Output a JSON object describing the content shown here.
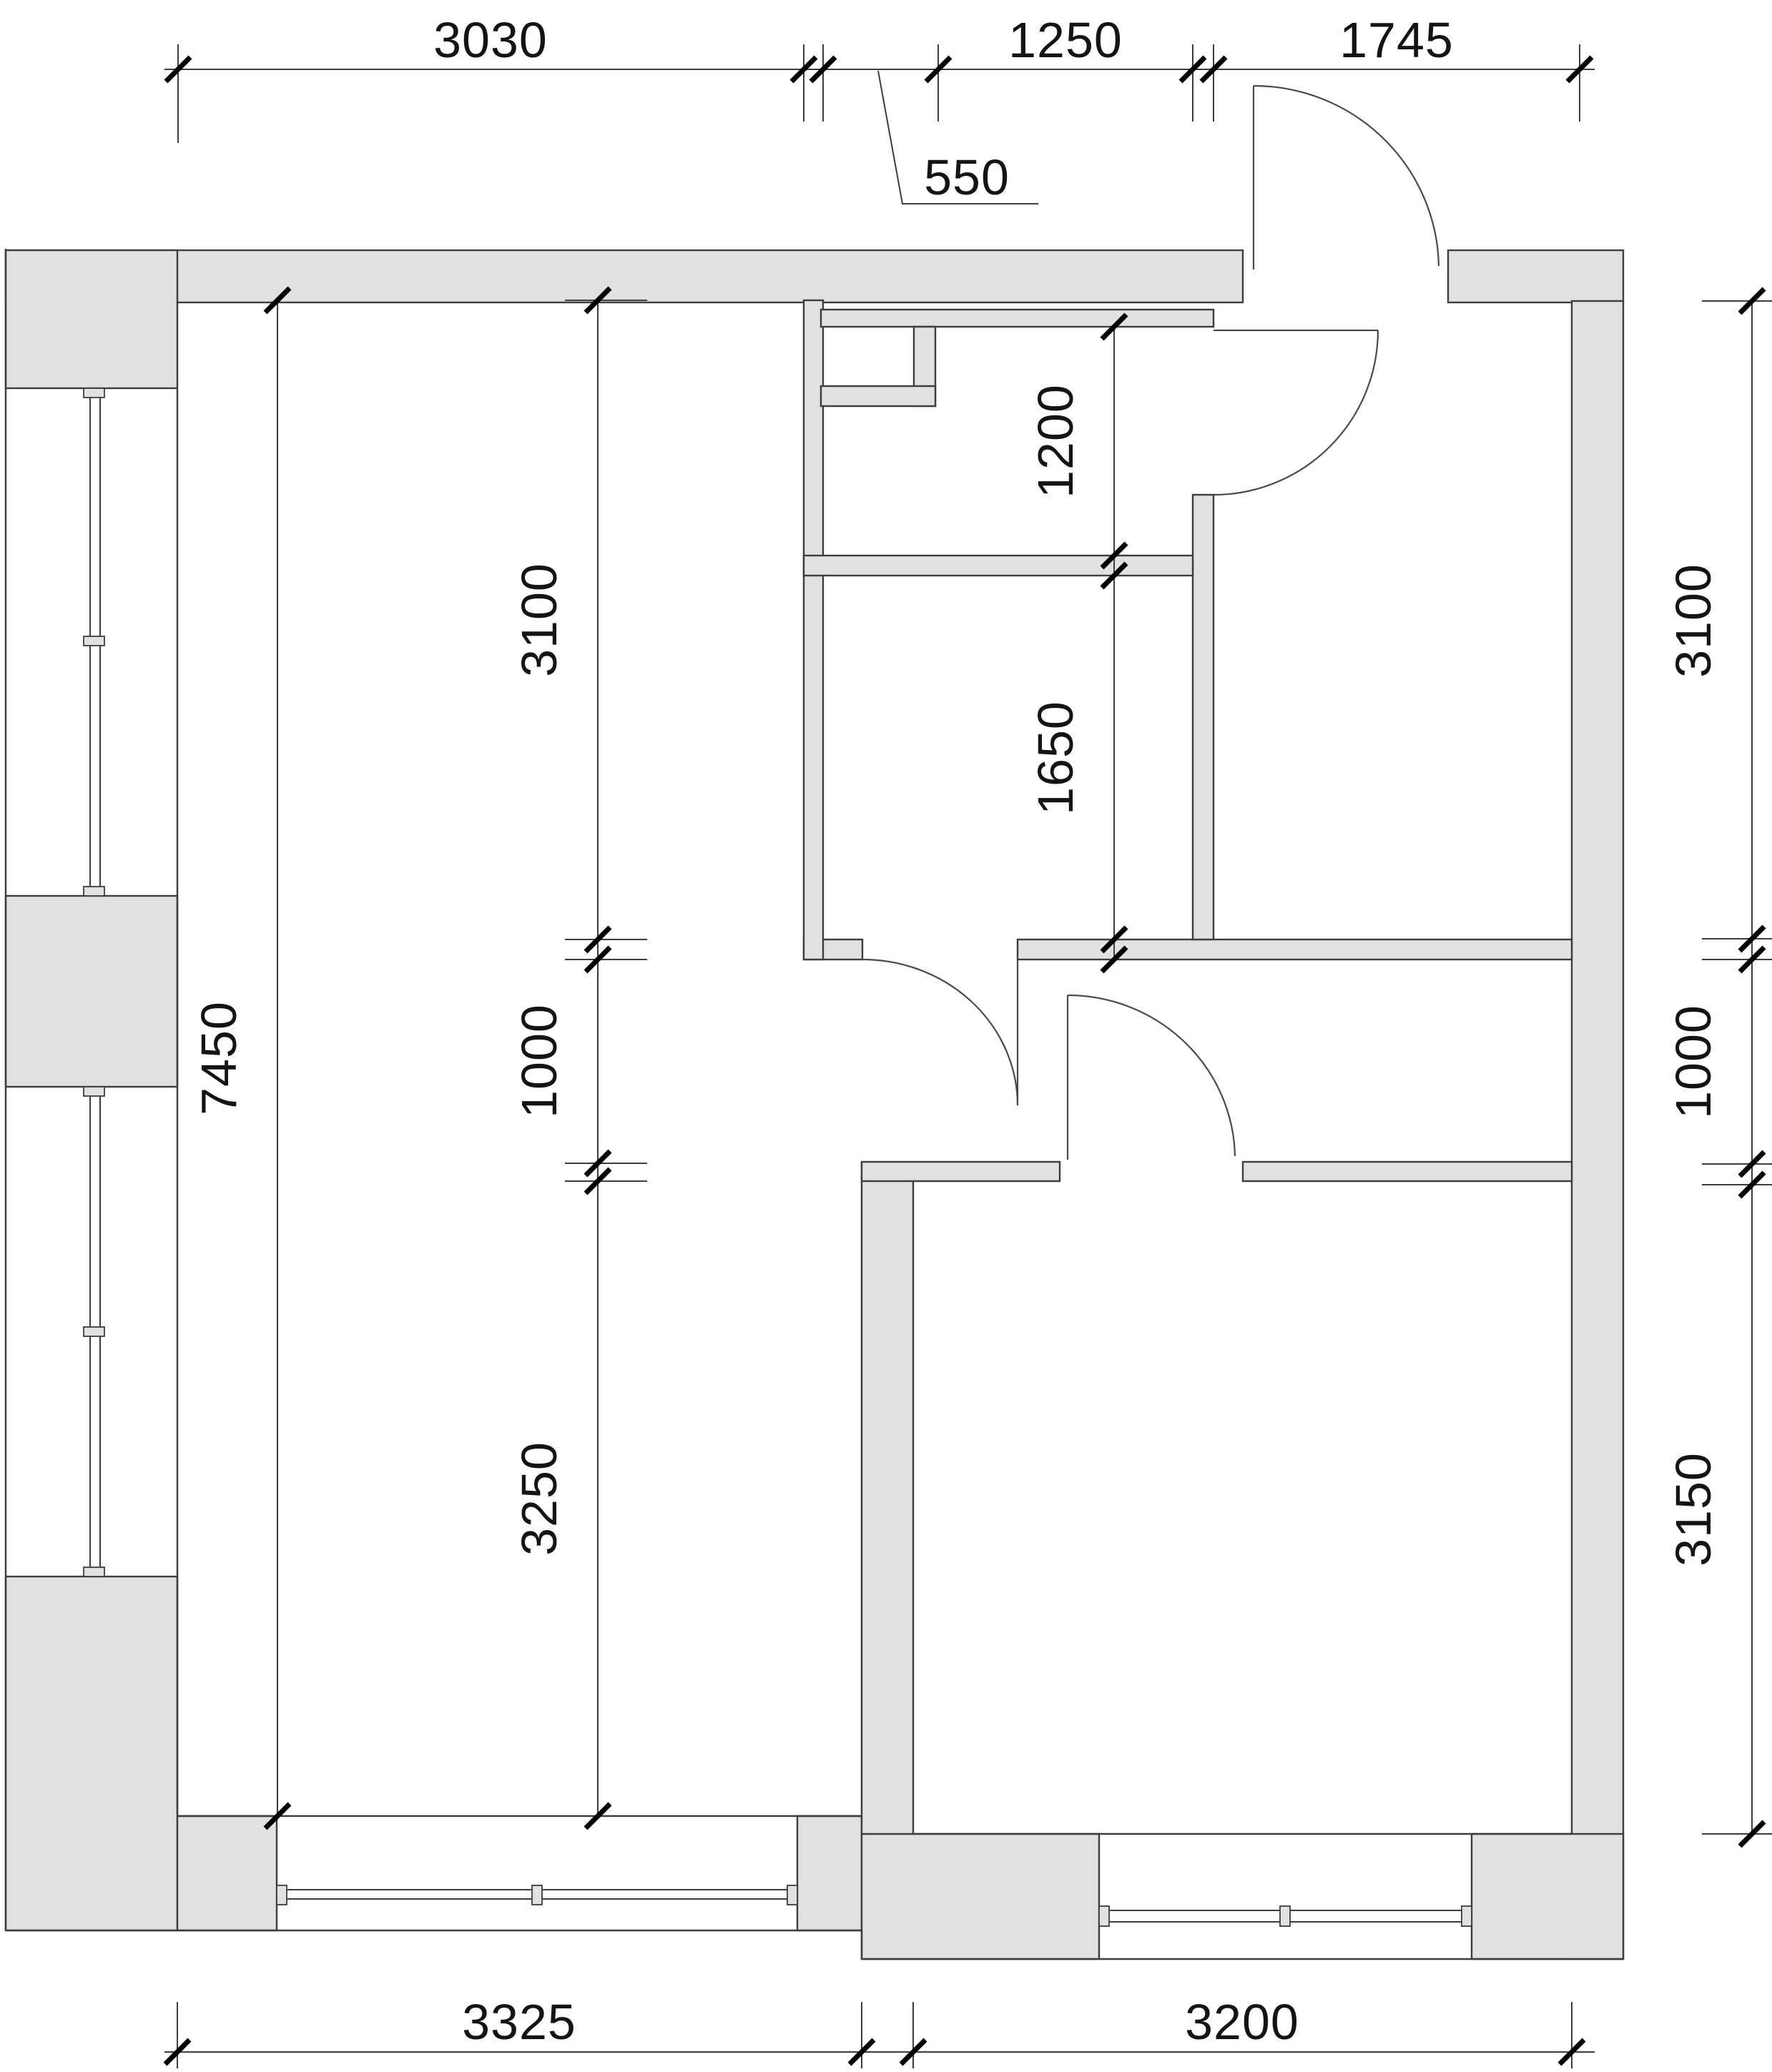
{
  "drawing": {
    "type": "architectural floor plan",
    "units": "mm"
  },
  "colors": {
    "wall_fill": "#e1e1e1",
    "line": "#3d3d3d",
    "tick": "#000000",
    "text": "#141414",
    "background": "#ffffff"
  },
  "dims": {
    "top": [
      "3030",
      "550",
      "1250",
      "1745"
    ],
    "left_outer": [
      "7450"
    ],
    "left_inner": [
      "3100",
      "1000",
      "3250"
    ],
    "middle": [
      "1200",
      "1650"
    ],
    "right": [
      "3100",
      "1000",
      "3150"
    ],
    "bottom": [
      "3325",
      "3200"
    ]
  }
}
